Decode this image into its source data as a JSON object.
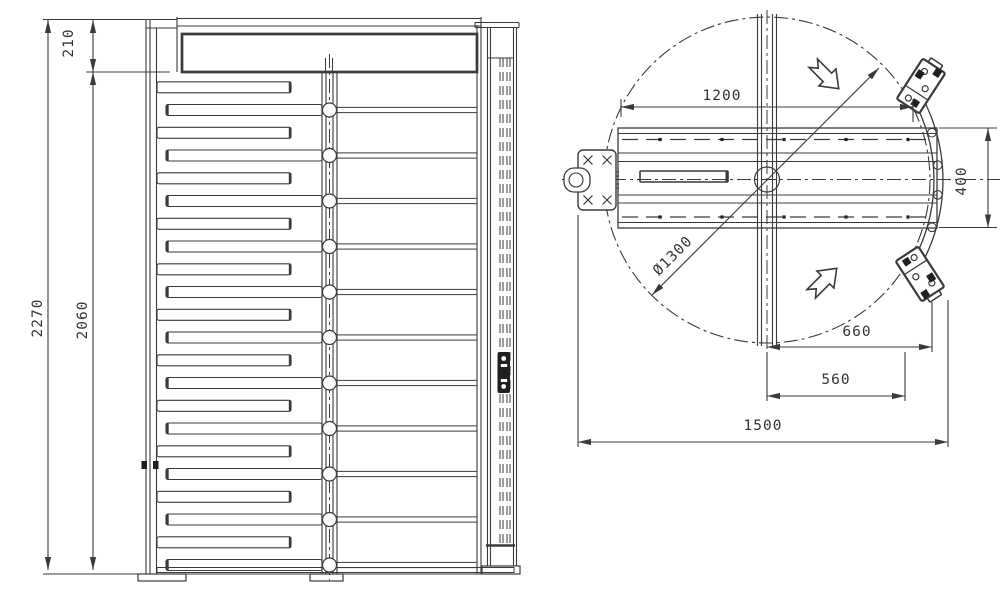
{
  "front_view": {
    "total_height": "2270",
    "rotor_height": "2060",
    "header_height": "210"
  },
  "plan_view": {
    "arm_span": "1200",
    "rotation_diameter": "Ø1300",
    "rail_width": "400",
    "center_to_reader": "660",
    "center_to_rail": "560",
    "overall_width": "1500"
  },
  "colors": {
    "line": "#3a3a3a",
    "dark": "#1f1f1f",
    "background": "#ffffff"
  }
}
